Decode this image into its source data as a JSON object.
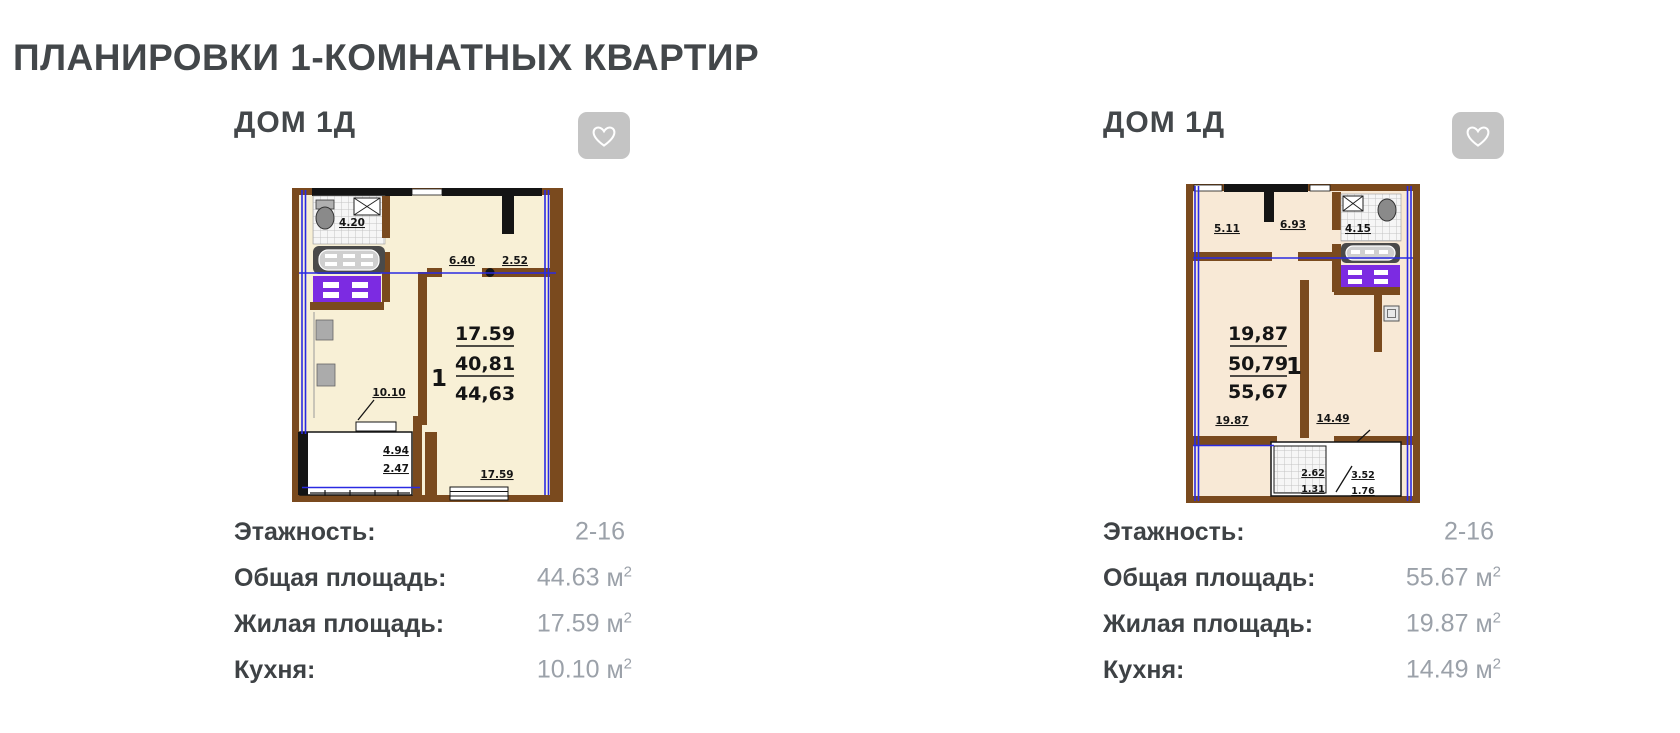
{
  "page": {
    "title": "ПЛАНИРОВКИ 1-КОМНАТНЫХ КВАРТИР"
  },
  "colors": {
    "heading_text": "#43474a",
    "value_text": "#9ba1a9",
    "favorite_button_bg": "#c4c4c4",
    "plan_wall_brown": "#7a4a1e",
    "plan_axis_blue": "#2a2ae2",
    "plan_washer_purple": "#7c2be2",
    "plan1_bg": "#f8f0d6",
    "plan2_bg": "#f8e9d6"
  },
  "cards": [
    {
      "title": "ДОМ 1Д",
      "favorite_icon": "heart-outline",
      "plan": {
        "unit_label": "1",
        "dims": {
          "bath": "4.20",
          "top_a": "6.40",
          "top_b": "2.52",
          "living": "17.59",
          "living_mid": "40,81",
          "total": "44,63",
          "kitchen": "10.10",
          "balcony_top": "4.94",
          "balcony_bottom": "2.47",
          "room_bottom": "17.59"
        }
      },
      "details": [
        {
          "label": "Этажность:",
          "value": "2-16",
          "unit": "",
          "sup": ""
        },
        {
          "label": "Общая площадь:",
          "value": "44.63",
          "unit": "м",
          "sup": "2"
        },
        {
          "label": "Жилая площадь:",
          "value": "17.59",
          "unit": "м",
          "sup": "2"
        },
        {
          "label": "Кухня:",
          "value": "10.10",
          "unit": "м",
          "sup": "2"
        }
      ]
    },
    {
      "title": "ДОМ 1Д",
      "favorite_icon": "heart-outline",
      "plan": {
        "unit_label": "1",
        "dims": {
          "top_a": "5.11",
          "top_b": "6.93",
          "bath": "4.15",
          "living": "19,87",
          "living_mid": "50,79",
          "total": "55,67",
          "room_bottom": "19.87",
          "kitchen": "14.49",
          "balcony_a_top": "2.62",
          "balcony_a_bottom": "1.31",
          "balcony_b_top": "3.52",
          "balcony_b_bottom": "1.76"
        }
      },
      "details": [
        {
          "label": "Этажность:",
          "value": "2-16",
          "unit": "",
          "sup": ""
        },
        {
          "label": "Общая площадь:",
          "value": "55.67",
          "unit": "м",
          "sup": "2"
        },
        {
          "label": "Жилая площадь:",
          "value": "19.87",
          "unit": "м",
          "sup": "2"
        },
        {
          "label": "Кухня:",
          "value": "14.49",
          "unit": "м",
          "sup": "2"
        }
      ]
    }
  ]
}
